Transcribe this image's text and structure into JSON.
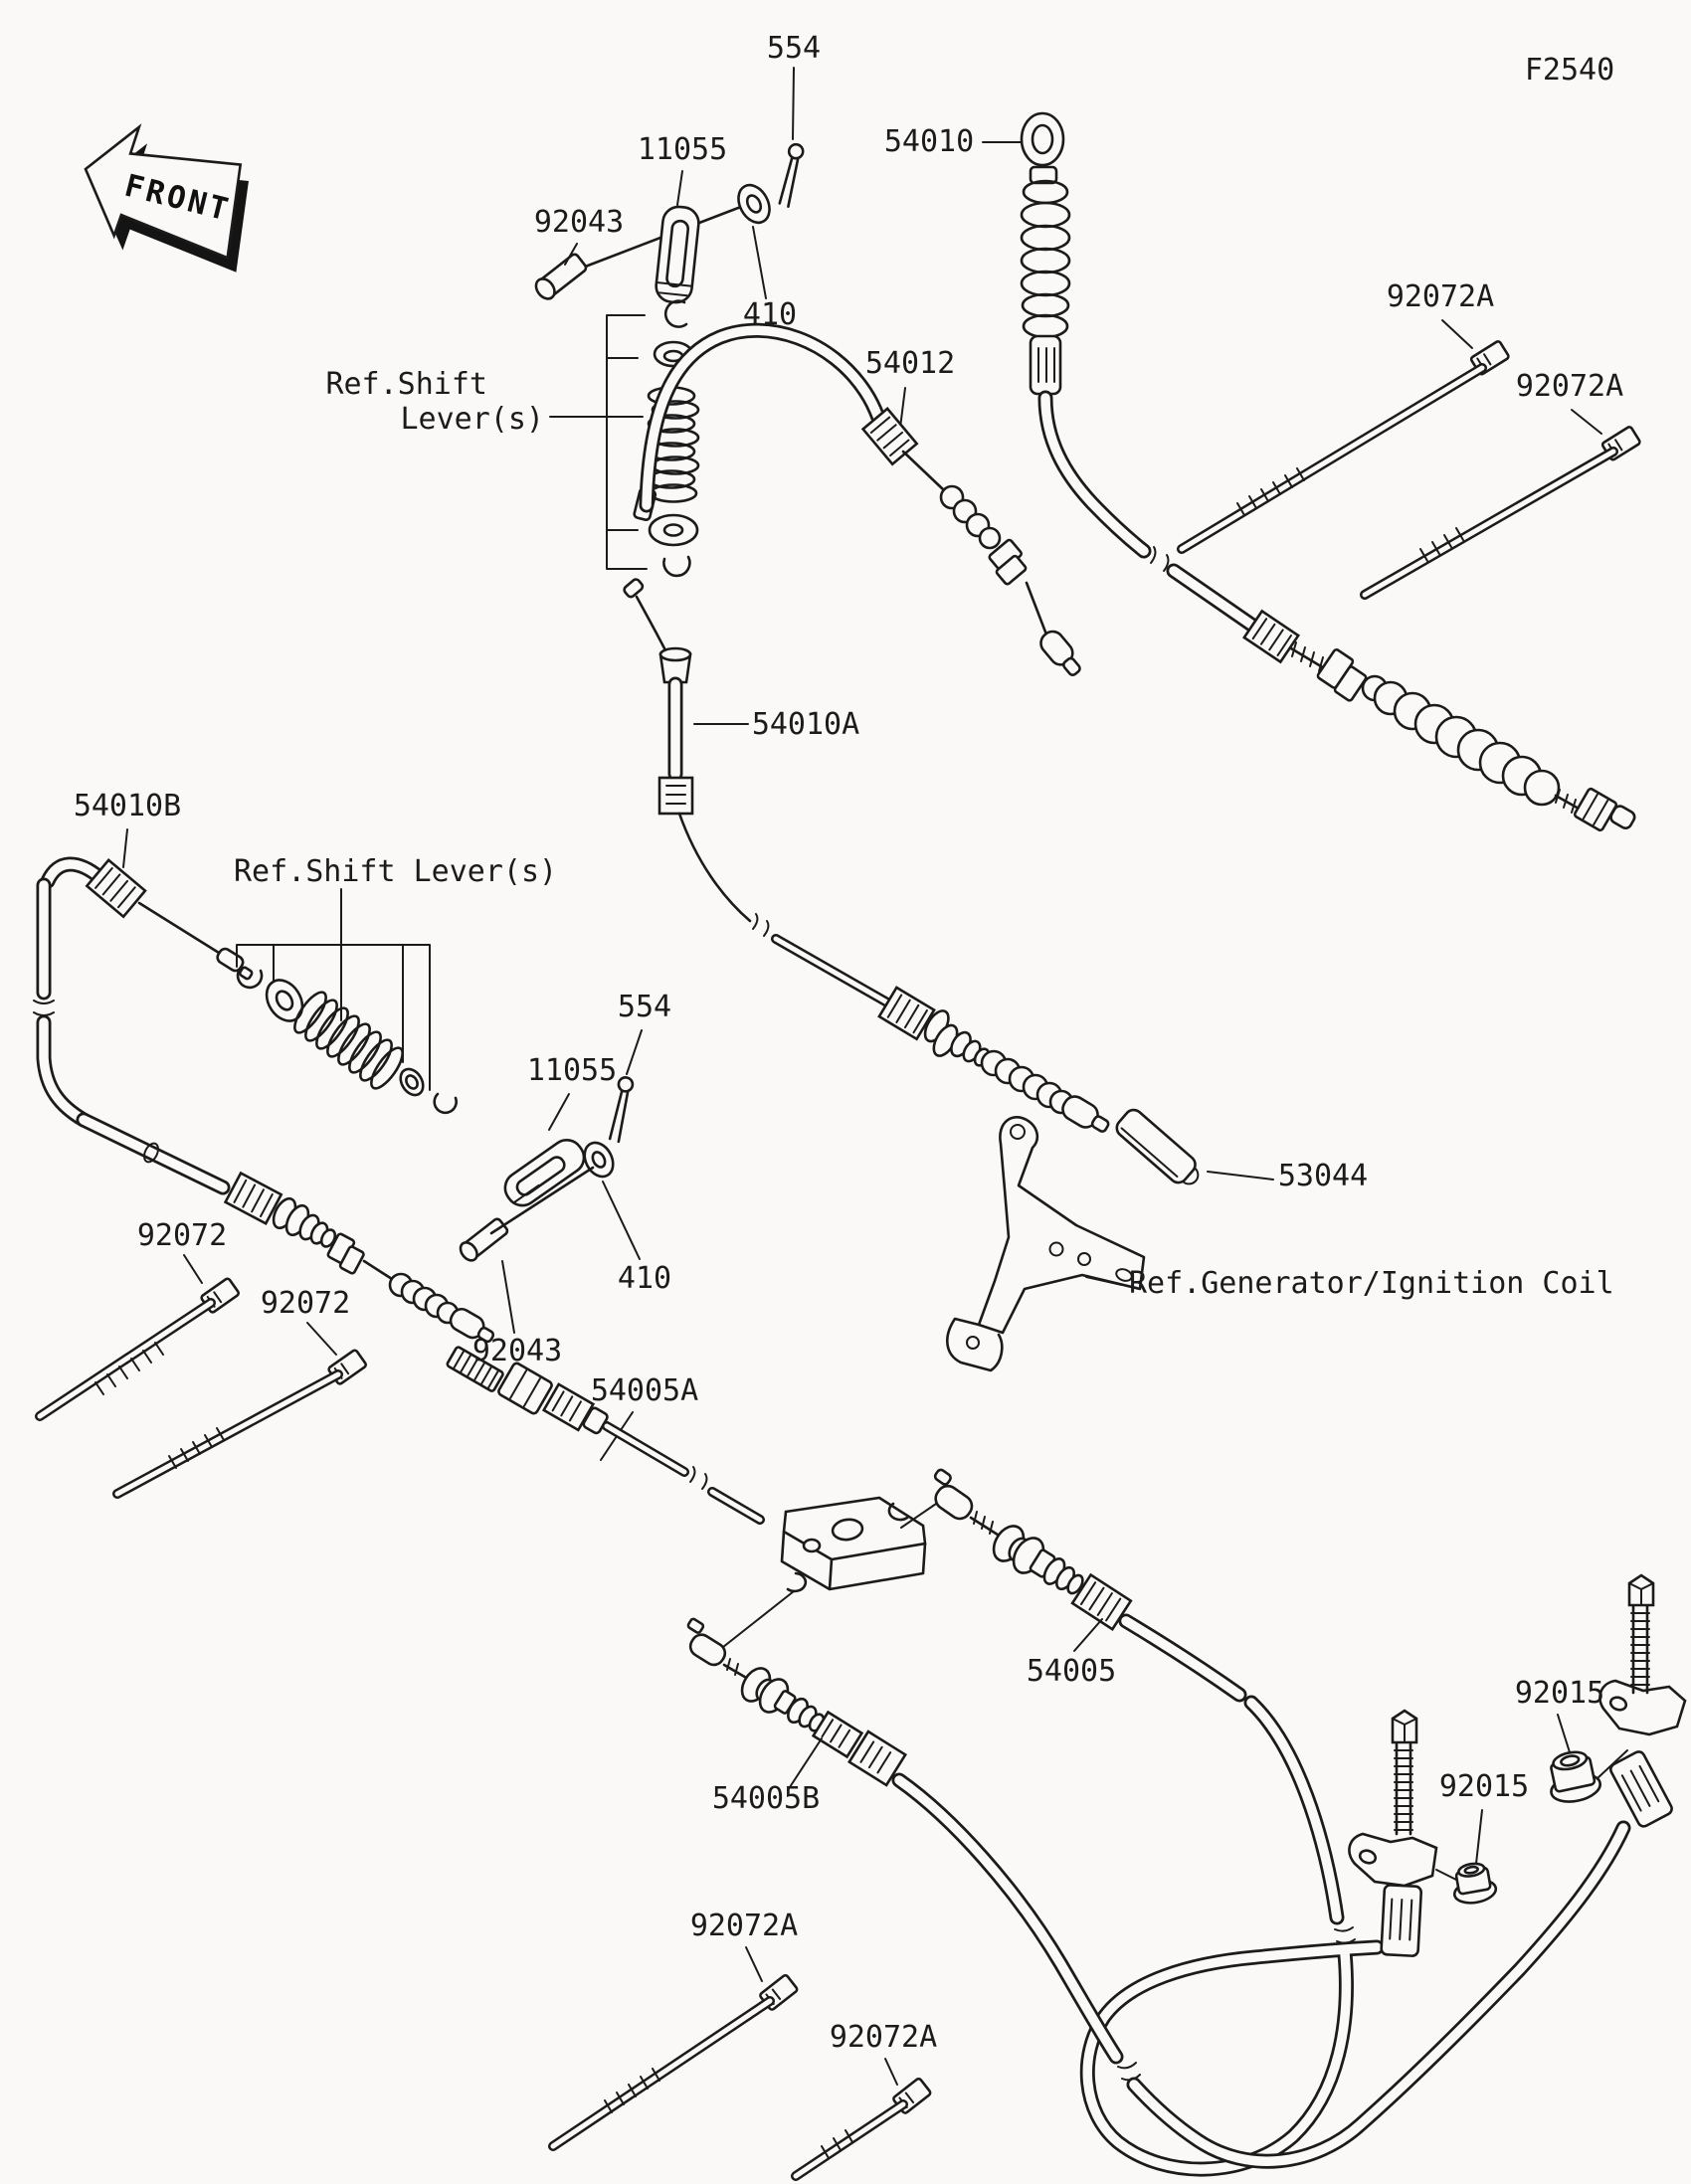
{
  "diagram": {
    "type": "exploded-parts-diagram",
    "code": "F2540",
    "line_color": "#1b1b1b",
    "background_color": "#faf9f7"
  },
  "labels": {
    "front": "FRONT",
    "code": "F2540",
    "p554_top": "554",
    "p11055_top": "11055",
    "p92043_top": "92043",
    "p410_top": "410",
    "p54010": "54010",
    "p54012": "54012",
    "p92072a_t1": "92072A",
    "p92072a_t2": "92072A",
    "ref_shift_1_l1": "Ref.Shift",
    "ref_shift_1_l2": "Lever(s)",
    "p54010a": "54010A",
    "p54010b": "54010B",
    "ref_shift_2": "Ref.Shift Lever(s)",
    "p554_2": "554",
    "p11055_2": "11055",
    "p410_2": "410",
    "p92043_2": "92043",
    "p92072_1": "92072",
    "p92072_2": "92072",
    "p53044": "53044",
    "ref_generator": "Ref.Generator/Ignition Coil",
    "p54005a": "54005A",
    "p54005": "54005",
    "p54005b": "54005B",
    "p92015_1": "92015",
    "p92015_2": "92015",
    "p92072a_b1": "92072A",
    "p92072a_b2": "92072A"
  }
}
